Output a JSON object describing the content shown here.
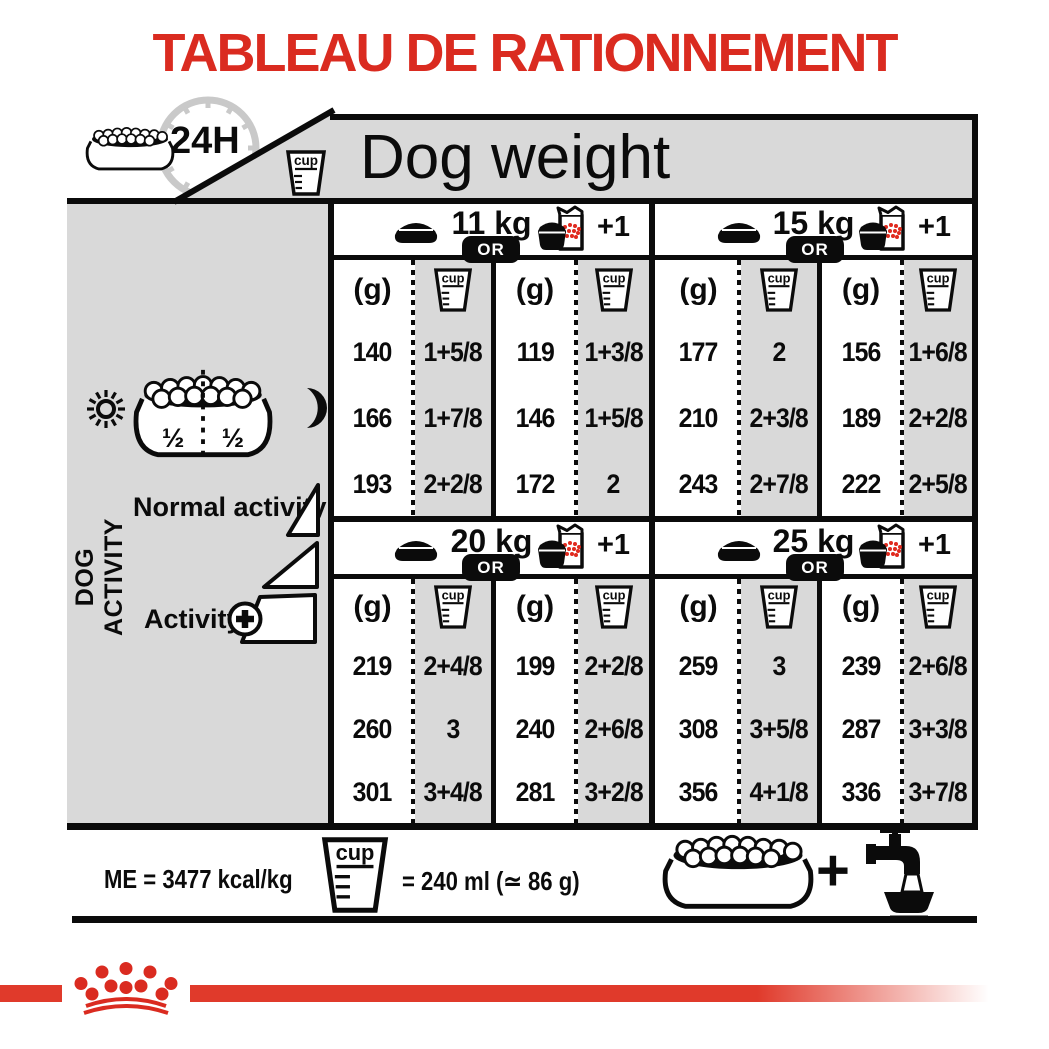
{
  "title": "TABLEAU DE RATIONNEMENT",
  "header": {
    "clock_label": "24H",
    "cup_label": "cup",
    "dog_weight_label": "Dog weight"
  },
  "sidebar": {
    "dog_activity_label": "DOG ACTIVITY",
    "half_left": "½",
    "half_right": "½",
    "normal_activity_label": "Normal activity",
    "activity_label": "Activity"
  },
  "sections": [
    {
      "weight": "11 kg",
      "or_label": "OR",
      "plus_one_label": "+1",
      "col_headers": [
        "(g)",
        "cup",
        "(g)",
        "cup"
      ],
      "rows": [
        [
          "140",
          "1+5/8",
          "119",
          "1+3/8"
        ],
        [
          "166",
          "1+7/8",
          "146",
          "1+5/8"
        ],
        [
          "193",
          "2+2/8",
          "172",
          "2"
        ]
      ]
    },
    {
      "weight": "15 kg",
      "or_label": "OR",
      "plus_one_label": "+1",
      "col_headers": [
        "(g)",
        "cup",
        "(g)",
        "cup"
      ],
      "rows": [
        [
          "177",
          "2",
          "156",
          "1+6/8"
        ],
        [
          "210",
          "2+3/8",
          "189",
          "2+2/8"
        ],
        [
          "243",
          "2+7/8",
          "222",
          "2+5/8"
        ]
      ]
    },
    {
      "weight": "20 kg",
      "or_label": "OR",
      "plus_one_label": "+1",
      "col_headers": [
        "(g)",
        "cup",
        "(g)",
        "cup"
      ],
      "rows": [
        [
          "219",
          "2+4/8",
          "199",
          "2+2/8"
        ],
        [
          "260",
          "3",
          "240",
          "2+6/8"
        ],
        [
          "301",
          "3+4/8",
          "281",
          "3+2/8"
        ]
      ]
    },
    {
      "weight": "25 kg",
      "or_label": "OR",
      "plus_one_label": "+1",
      "col_headers": [
        "(g)",
        "cup",
        "(g)",
        "cup"
      ],
      "rows": [
        [
          "259",
          "3",
          "239",
          "2+6/8"
        ],
        [
          "308",
          "3+5/8",
          "287",
          "3+3/8"
        ],
        [
          "356",
          "4+1/8",
          "336",
          "3+7/8"
        ]
      ]
    }
  ],
  "footer_note": {
    "me_label": "ME = 3477 kcal/kg",
    "cup_label": "cup",
    "equiv_label": "= 240 ml (≃ 86 g)",
    "plus_label": "+"
  },
  "icons": [
    "bowl-kibble-icon",
    "clock-24h-icon",
    "measuring-cup-icon",
    "bowl-icon",
    "bowl-plus-bag-icon",
    "sun-icon",
    "moon-icon",
    "half-bowl-icon",
    "activity-ramp-icon",
    "plus-circle-icon",
    "tap-water-icon",
    "royal-canin-crown-icon"
  ],
  "colors": {
    "red": "#da2b20",
    "band_red": "#e03a2b",
    "kibble_red": "#e02a1e",
    "gray": "#d9d9d9",
    "black": "#0b0b0b"
  }
}
